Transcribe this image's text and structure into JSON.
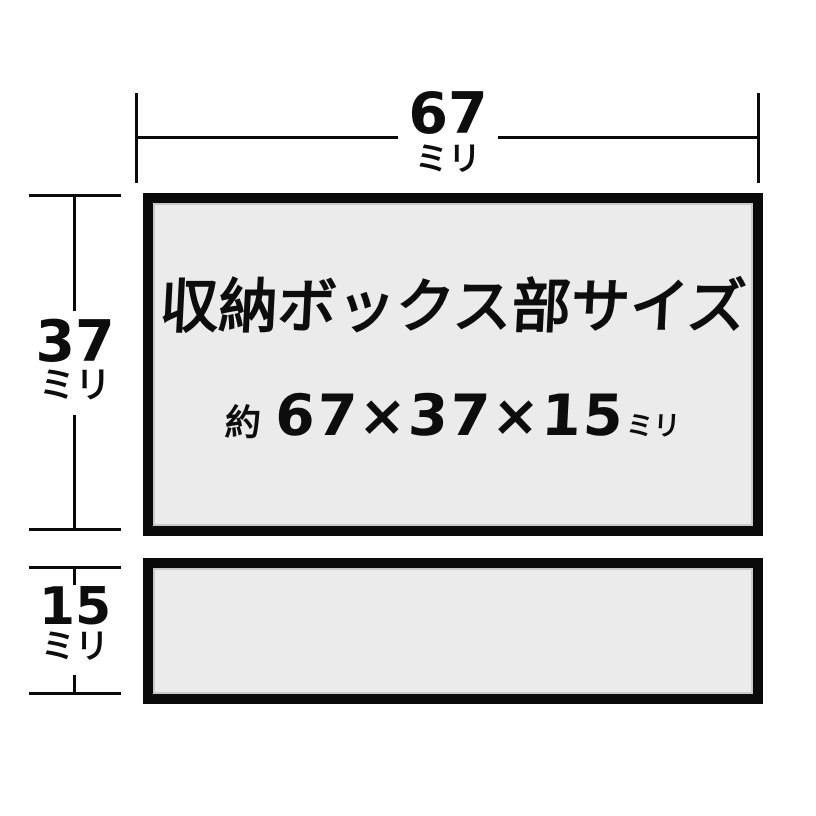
{
  "colors": {
    "background": "#ffffff",
    "box_fill": "#ebebeb",
    "line": "#0a0a0a",
    "text": "#0d0d0d"
  },
  "dimensions": {
    "width": {
      "value": "67",
      "unit": "ミリ"
    },
    "height": {
      "value": "37",
      "unit": "ミリ"
    },
    "depth": {
      "value": "15",
      "unit": "ミリ"
    }
  },
  "storage_box": {
    "title": "収納ボックス部サイズ",
    "approx_label": "約",
    "size_text": "67×37×15",
    "size_unit": "ミリ"
  }
}
